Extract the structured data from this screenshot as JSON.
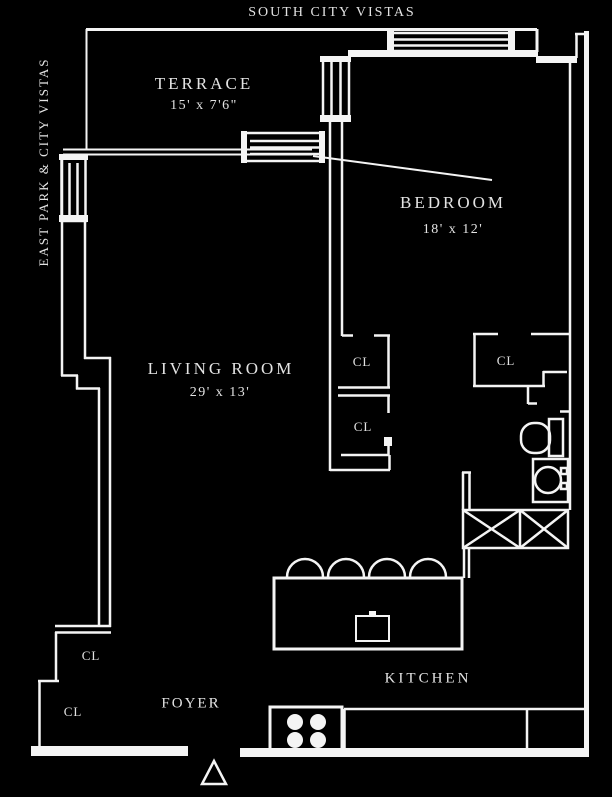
{
  "plan": {
    "exposures": {
      "top": "SOUTH CITY VISTAS",
      "left": "EAST PARK & CITY VISTAS"
    },
    "rooms": {
      "terrace": {
        "name": "TERRACE",
        "dims": "15' x 7'6\""
      },
      "bedroom": {
        "name": "BEDROOM",
        "dims": "18' x 12'"
      },
      "living_room": {
        "name": "LIVING ROOM",
        "dims": "29' x 13'"
      },
      "kitchen": {
        "name": "KITCHEN"
      },
      "foyer": {
        "name": "FOYER"
      }
    },
    "closet_label": "CL",
    "colors": {
      "background": "#000000",
      "walls": "#f4f4f4",
      "text": "#e3e3e3"
    }
  }
}
